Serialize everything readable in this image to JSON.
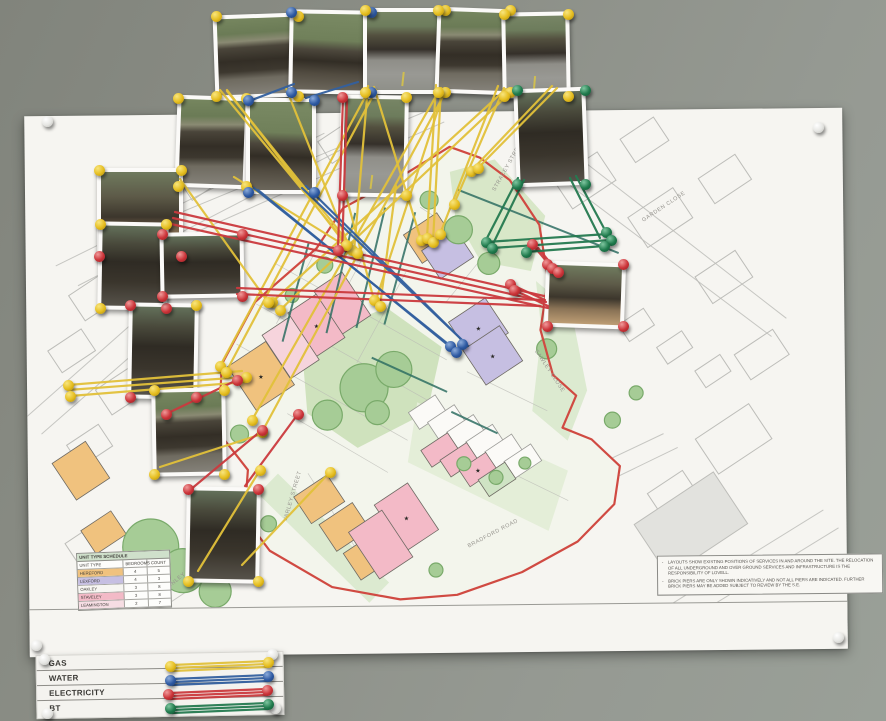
{
  "legend_board": {
    "rows": [
      {
        "label": "GAS",
        "color": "#e2c13a"
      },
      {
        "label": "WATER",
        "color": "#33609f"
      },
      {
        "label": "ELECTRICITY",
        "color": "#cb3a3e"
      },
      {
        "label": "BT",
        "color": "#257a50"
      }
    ]
  },
  "plan": {
    "street_labels": [
      "STRACEY STREET",
      "GARDEN CLOSE",
      "SAWLEY CLOSE",
      "VARLEY STREET",
      "CHARNLEY CLOSE",
      "BRADFORD ROAD"
    ],
    "unit_schedule": {
      "title": "UNIT TYPE SCHEDULE",
      "columns": [
        "UNIT TYPE",
        "BEDROOMS",
        "COUNT"
      ],
      "rows": [
        {
          "name": "HEREFORD",
          "bedrooms": "4",
          "count": "5",
          "color": "#f0c27e"
        },
        {
          "name": "LEXFORD",
          "bedrooms": "4",
          "count": "3",
          "color": "#c6bfe2"
        },
        {
          "name": "OAKLEY",
          "bedrooms": "3",
          "count": "8",
          "color": "#f7f6f2"
        },
        {
          "name": "STAVELEY",
          "bedrooms": "3",
          "count": "8",
          "color": "#f3bac7"
        },
        {
          "name": "LEAMINGTON",
          "bedrooms": "2",
          "count": "7",
          "color": "#f6dde3"
        }
      ]
    },
    "drawing_callout": {
      "number": "1",
      "title": "Proposed Site Plan",
      "scale": "1:250"
    },
    "map_legend": [
      {
        "label": "Tree Retained",
        "swatch": "#b9d6bd"
      },
      {
        "label": "Proposed Indicative Planting (For exact details and locations of planting refer to Arboricultural Tree Plan AT-01 1236 100 P01)",
        "swatch": "#9ccb9b"
      }
    ],
    "revision_table_columns": [
      "Rev",
      "Date",
      "Description"
    ],
    "notes": [
      "LAYOUTS SHOW EXISTING POSITIONS OF SERVICES IN AND AROUND THE SITE. THE RELOCATION OF ALL UNDERGROUND AND OVER GROUND SERVICES AND INFRASTRUCTURE IS THE RESPONSIBILITY OF LOVELL.",
      "BRICK PIERS ARE ONLY SHOWN INDICATIVELY AND NOT ALL PIERS ARE INDICATED. FURTHER BRICK PIERS MAY BE ADDED SUBJECT TO REVIEW BY THE S.E."
    ],
    "title_block": {
      "project": "Miles Platting Cell 7.5",
      "drawing_title": "Proposed Site Plan",
      "drawing_number": "BA5862-30104",
      "revision": "REV C07",
      "status": "CONSTRUCTION",
      "logo": "PRP"
    },
    "string_colors": {
      "gas": "#e2c13a",
      "water": "#33609f",
      "electricity": "#cb3a3e",
      "bt": "#257a50"
    },
    "boundary_color": "#d04a42"
  }
}
